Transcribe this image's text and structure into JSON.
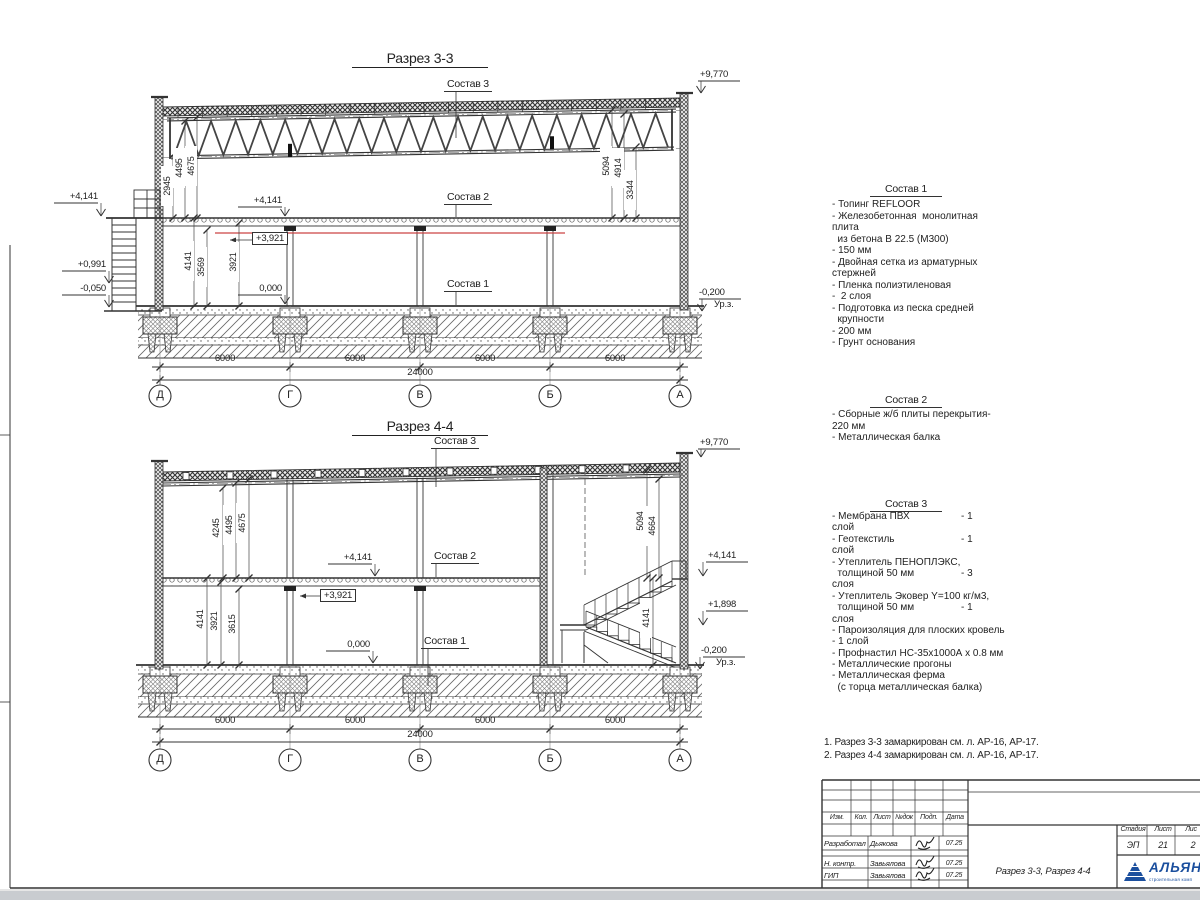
{
  "colors": {
    "line": "#333333",
    "red_line": "#cc4444",
    "logo_blue": "#1b4f9e"
  },
  "sections": {
    "s33": {
      "title": "Разрез 3-3",
      "sostav1": "Состав 1",
      "sostav2": "Состав 2",
      "sostav3": "Состав 3",
      "elev_roof": "+9,770",
      "elev_slab_left": "+4,141",
      "elev_0991": "+0,991",
      "elev_m0050": "-0,050",
      "elev_slab_in": "+4,141",
      "elev_3921": "+3,921",
      "elev_zero": "0,000",
      "elev_ground": "-0,200",
      "ground_label": "Ур.з.",
      "dims_left": [
        "2945",
        "4495",
        "4675"
      ],
      "dims_mid": [
        "4141",
        "3569",
        "3921"
      ],
      "dims_right": [
        "5094",
        "4914",
        "3344"
      ],
      "bay_dims": [
        "6000",
        "6000",
        "6000",
        "6000"
      ],
      "total_dim": "24000",
      "grid": [
        "Д",
        "Г",
        "В",
        "Б",
        "А"
      ]
    },
    "s44": {
      "title": "Разрез 4-4",
      "sostav1": "Состав 1",
      "sostav2": "Состав 2",
      "sostav3": "Состав 3",
      "elev_roof": "+9,770",
      "elev_slab_in": "+4,141",
      "elev_3921": "+3,921",
      "elev_zero": "0,000",
      "elev_slab_right": "+4,141",
      "elev_1898": "+1,898",
      "elev_ground": "-0,200",
      "ground_label": "Ур.з.",
      "dims_left_upper": [
        "4245",
        "4495",
        "4675"
      ],
      "dims_left_lower": [
        "4141",
        "3921",
        "3615"
      ],
      "dims_right": [
        "5094",
        "4664",
        "4141"
      ],
      "bay_dims": [
        "6000",
        "6000",
        "6000",
        "6000"
      ],
      "total_dim": "24000",
      "grid": [
        "Д",
        "Г",
        "В",
        "Б",
        "А"
      ]
    }
  },
  "specs": {
    "s1": {
      "title": "Состав 1",
      "lines": [
        "- Топинг REFLOOR",
        "- Железобетонная  монолитная",
        "плита",
        "  из бетона В 22.5 (М300)",
        "- 150 мм",
        "- Двойная сетка из арматурных",
        "стержней",
        "- Пленка полиэтиленовая",
        "-  2 слоя",
        "- Подготовка из песка средней",
        "  крупности",
        "- 200 мм",
        "- Грунт основания"
      ]
    },
    "s2": {
      "title": "Состав 2",
      "lines": [
        "- Сборные ж/б плиты перекрытия-",
        "220 мм",
        "- Металлическая балка"
      ]
    },
    "s3": {
      "title": "Состав 3",
      "lines": [
        {
          "t": "- Мембрана ПВХ",
          "v": "- 1"
        },
        {
          "t": "слой",
          "v": ""
        },
        {
          "t": "- Геотекстиль",
          "v": "- 1"
        },
        {
          "t": "слой",
          "v": ""
        },
        {
          "t": "- Утеплитель ПЕНОПЛЭКС,",
          "v": ""
        },
        {
          "t": "  толщиной 50 мм",
          "v": "- 3"
        },
        {
          "t": "слоя",
          "v": ""
        },
        {
          "t": "- Утеплитель Эковер Y=100 кг/м3,",
          "v": ""
        },
        {
          "t": "  толщиной 50 мм",
          "v": "- 1"
        },
        {
          "t": "слоя",
          "v": ""
        },
        {
          "t": "- Пароизоляция для плоских кровель",
          "v": ""
        },
        {
          "t": "- 1 слой",
          "v": ""
        },
        {
          "t": "- Профнастил НС-35х1000А х 0.8 мм",
          "v": ""
        },
        {
          "t": "- Металлические прогоны",
          "v": ""
        },
        {
          "t": "- Металлическая ферма",
          "v": ""
        },
        {
          "t": "  (с торца металлическая балка)",
          "v": ""
        }
      ]
    }
  },
  "notes": [
    "1. Разрез 3-3 замаркирован см. л. АР-16, АР-17.",
    "2. Разрез 4-4 замаркирован см. л. АР-16, АР-17."
  ],
  "stamp": {
    "cols": [
      "Изм.",
      "Кол.",
      "Лист",
      "№док",
      "Подп.",
      "Дата"
    ],
    "rows": [
      {
        "role": "Разработал",
        "name": "Дьякова",
        "date": "07.25"
      },
      {
        "role": "Н. контр.",
        "name": "Завьялова",
        "date": "07.25"
      },
      {
        "role": "ГИП",
        "name": "Завьялова",
        "date": "07.25"
      }
    ],
    "doc_title": "Разрез 3-3, Разрез 4-4",
    "stage_cols": [
      "Стадия",
      "Лист",
      "Лис"
    ],
    "stage_vals": [
      "ЭП",
      "21",
      "2"
    ],
    "logo": {
      "name": "АЛЬЯН",
      "sub": "строительная комп"
    }
  }
}
